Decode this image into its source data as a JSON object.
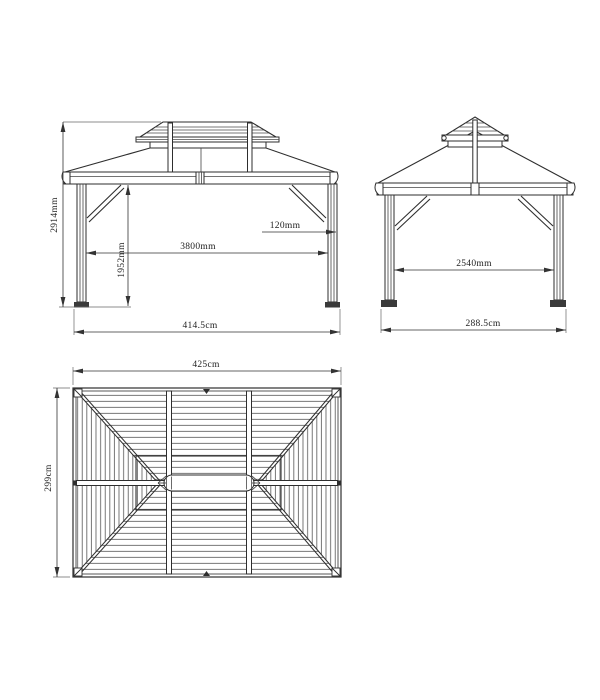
{
  "drawing_title": "gazebo-dimension-drawing",
  "front_view": {
    "dim_height": "2914mm",
    "dim_clear_height": "1952mm",
    "dim_span": "3800mm",
    "dim_post": "120mm",
    "dim_overall_width": "414.5cm"
  },
  "side_view": {
    "dim_span": "2540mm",
    "dim_overall_width": "288.5cm"
  },
  "plan_view": {
    "dim_width": "425cm",
    "dim_depth": "299cm"
  },
  "colors": {
    "line": "#333333",
    "roof_fill": "#c9c9c9",
    "roof_slat_line": "#3c3c3c",
    "background": "#ffffff"
  }
}
